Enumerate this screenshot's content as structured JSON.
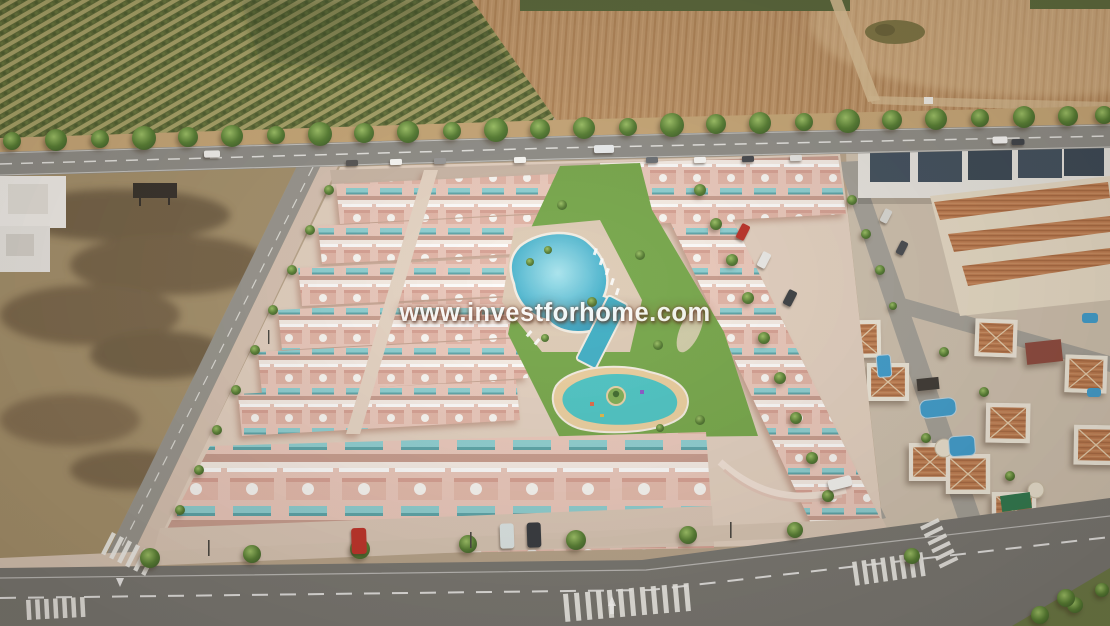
{
  "meta": {
    "type": "aerial-render-photo",
    "description": "Aerial 3D render of a new-build salmon-pink townhouse development with communal lagoon, lap and children's pools, beside an existing villa neighborhood, bordered by an orchard, a plowed field and a tree-lined road."
  },
  "watermark": {
    "text": "www.investforhome.com",
    "color": "#ffffff"
  },
  "scene": {
    "regions": {
      "orchard_field": "orchard with planted tree rows",
      "plowed_field": "plowed farmland with dirt track",
      "tree_lined_road": "tree-lined main road with cars",
      "vacant_lot": "vacant scrubland plot",
      "new_development": "pink townhouses with roof terraces, parasols and teal awnings",
      "lagoon_pool": "communal lagoon-style pool with sun loungers",
      "lap_pool": "communal lap pool",
      "kids_pool": "children's splash pool with palm island",
      "existing_neighborhood": "white villas with terracotta roofs and private pools",
      "bottom_road": "foreground road with zebra crossings and lane arrows"
    },
    "palette": {
      "orchard_green": "#5d6b37",
      "orchard_gap": "#a8a469",
      "plowed_tan": "#bd9468",
      "vacant_dirt": "#a5916c",
      "asphalt": "#8f8e89",
      "asphalt_dark": "#787772",
      "development_pink": "#eccabe",
      "white_trim": "#f8efe8",
      "awning_teal": "#8ed1d4",
      "lawn_green": "#76a84b",
      "lagoon_blue": "#49b4cf",
      "kids_pool_turquoise": "#4cc6c6",
      "sand_beige": "#ecd0a0",
      "terracotta_roof": "#bf7d51",
      "navy_facade": "#41505f"
    }
  }
}
